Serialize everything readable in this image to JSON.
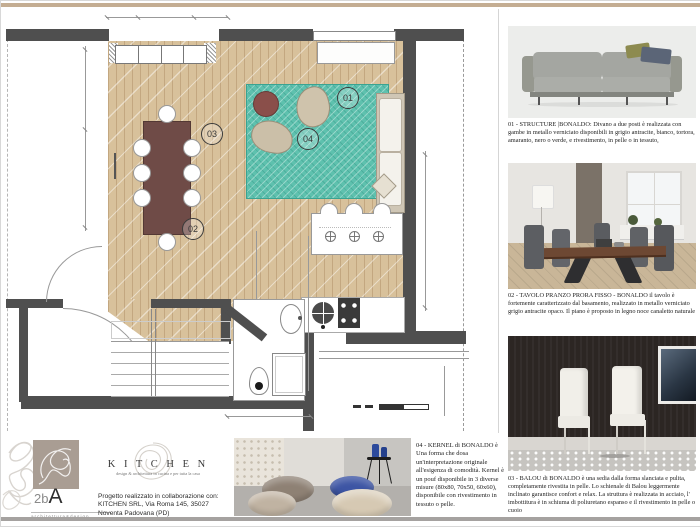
{
  "board_title": "interior design presentation board",
  "colors": {
    "accent_top_strip": "#c4ad92",
    "wall": "#4f4f4f",
    "wood_floor": "#d8c19b",
    "rug_teal": "#5ec1ae",
    "table_plan": "#6f4b47",
    "logo_square": "#a99d93"
  },
  "plan": {
    "labels": [
      "01",
      "02",
      "03",
      "04"
    ]
  },
  "products": [
    {
      "num": "01",
      "text": "01 - STRUCTURE |BONALDO: Divano a due posti è realizzata con gambe in metallo verniciato disponibili in grigio antracite, bianco, tortora, amaranto, nero o verde, e rivestimento, in pelle o in tessuto,"
    },
    {
      "num": "02",
      "text": "02 - TAVOLO PRANZO PRORA FISSO - BONALDO  il tavolo è fortemente caratterizzato dal basamento, realizzato in metallo verniciato grigio antracite opaco. Il piano è proposto in legno noce canaletto naturale"
    },
    {
      "num": "03",
      "text": "03 -  BALOU di BONALDO è una sedia dalla forma slanciata e pulita, completamente rivestita in pelle. Lo schienale di Balou leggermente inclinato garantisce confort e relax. La struttura è realizzata in acciaio, l' imbottitura è in schiuma di poliuretano espanso e il rivestimento in pelle o cuoio"
    },
    {
      "num": "04",
      "text": "04 - KERNEL di BONALDO è Una forma che dosa un'interpretazione originale all'esigenza di comodità. Kernel è un pouf disponibile in 3 diverse misure (80x80, 70x50, 60x60), disponibile con rivestimento in tessuto o pelle."
    }
  ],
  "footer": {
    "logo2ba": {
      "prefix": "2b",
      "suffix": "A",
      "sub": "architettura&design"
    },
    "kitchen": {
      "name": "K I T C H E N",
      "tagline": "design & architettura in cucina e per tutta la casa"
    },
    "progetto": "Progetto realizzato in collaborazione con:\nKITCHEN SRL, Via Roma 145, 35027\nNoventa Padovana (PD)"
  }
}
